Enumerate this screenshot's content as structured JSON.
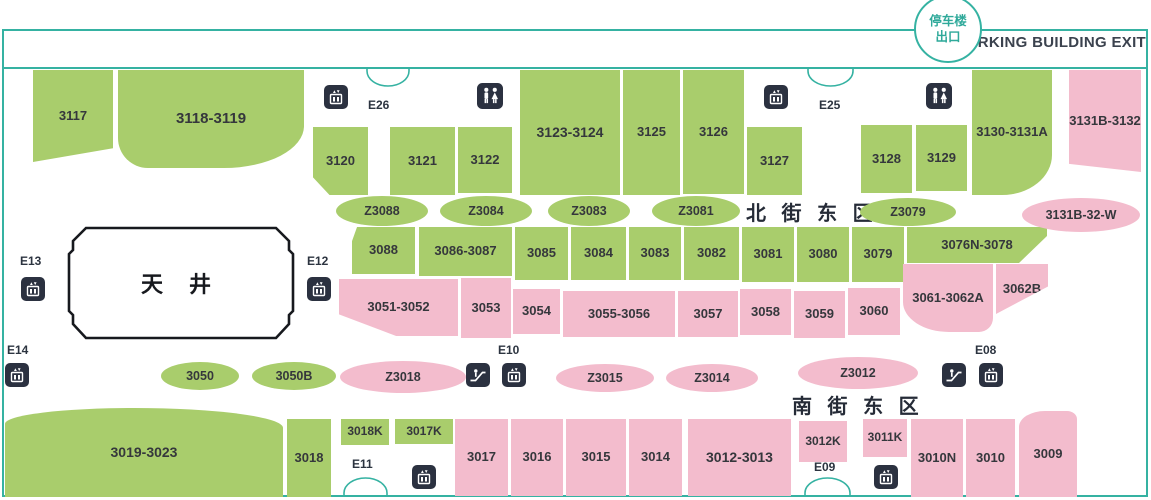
{
  "header": {
    "circle_line1": "停车楼",
    "circle_line2": "出口",
    "exit_text": "PARKING BUILDING EXIT"
  },
  "districts": {
    "north": "北 街 东 区",
    "south": "南 街 东 区"
  },
  "atrium": {
    "label": "天 井"
  },
  "colors": {
    "teal": "#35b2a2",
    "green": "#a9cd6c",
    "pink": "#f3bccd",
    "icon_bg": "#2b3140",
    "text_dark": "#35373c"
  },
  "shops": [
    {
      "label": "3117",
      "x": 33,
      "y": 70,
      "w": 80,
      "h": 92,
      "color": "green",
      "clip": "polygon(0 0,100% 0,100% 85%,0 100%)"
    },
    {
      "label": "3118-3119",
      "x": 118,
      "y": 70,
      "w": 186,
      "h": 98,
      "color": "green",
      "r": "0 0 80px 30px / 0 0 42px 30px",
      "fs": 15
    },
    {
      "label": "3120",
      "x": 313,
      "y": 127,
      "w": 55,
      "h": 68,
      "color": "green",
      "clip": "polygon(0 0,100% 0,100% 100%,30% 100%,0 74%)"
    },
    {
      "label": "3121",
      "x": 390,
      "y": 127,
      "w": 65,
      "h": 68,
      "color": "green"
    },
    {
      "label": "3122",
      "x": 458,
      "y": 127,
      "w": 54,
      "h": 66,
      "color": "green"
    },
    {
      "label": "3123-3124",
      "x": 520,
      "y": 70,
      "w": 100,
      "h": 125,
      "color": "green",
      "fs": 14
    },
    {
      "label": "3125",
      "x": 623,
      "y": 70,
      "w": 57,
      "h": 125,
      "color": "green"
    },
    {
      "label": "3126",
      "x": 683,
      "y": 70,
      "w": 61,
      "h": 124,
      "color": "green"
    },
    {
      "label": "3127",
      "x": 747,
      "y": 127,
      "w": 55,
      "h": 68,
      "color": "green"
    },
    {
      "label": "3128",
      "x": 861,
      "y": 125,
      "w": 51,
      "h": 68,
      "color": "green"
    },
    {
      "label": "3129",
      "x": 916,
      "y": 125,
      "w": 51,
      "h": 66,
      "color": "green"
    },
    {
      "label": "3130-3131A",
      "x": 972,
      "y": 70,
      "w": 80,
      "h": 125,
      "color": "green",
      "r": "0 0 50px 0 / 0 0 40px 0"
    },
    {
      "label": "3131B-3132",
      "x": 1069,
      "y": 70,
      "w": 72,
      "h": 102,
      "color": "pink",
      "clip": "polygon(0 0,100% 0,100% 100%,0 92%)"
    },
    {
      "label": "3088",
      "x": 352,
      "y": 227,
      "w": 63,
      "h": 47,
      "color": "green",
      "clip": "polygon(8% 0,100% 0,100% 100%,0 100%,0 30%)"
    },
    {
      "label": "3086-3087",
      "x": 419,
      "y": 227,
      "w": 93,
      "h": 49,
      "color": "green"
    },
    {
      "label": "3085",
      "x": 515,
      "y": 227,
      "w": 53,
      "h": 53,
      "color": "green"
    },
    {
      "label": "3084",
      "x": 571,
      "y": 227,
      "w": 55,
      "h": 53,
      "color": "green"
    },
    {
      "label": "3083",
      "x": 629,
      "y": 227,
      "w": 52,
      "h": 53,
      "color": "green"
    },
    {
      "label": "3082",
      "x": 684,
      "y": 227,
      "w": 55,
      "h": 53,
      "color": "green"
    },
    {
      "label": "3081",
      "x": 742,
      "y": 227,
      "w": 52,
      "h": 55,
      "color": "green"
    },
    {
      "label": "3080",
      "x": 797,
      "y": 227,
      "w": 52,
      "h": 55,
      "color": "green"
    },
    {
      "label": "3079",
      "x": 852,
      "y": 227,
      "w": 52,
      "h": 55,
      "color": "green"
    },
    {
      "label": "3076N-3078",
      "x": 907,
      "y": 227,
      "w": 140,
      "h": 36,
      "color": "green",
      "clip": "polygon(0 0,100% 0,100% 25%,80% 100%,0 100%)"
    },
    {
      "label": "3051-3052",
      "x": 339,
      "y": 279,
      "w": 119,
      "h": 57,
      "color": "pink",
      "clip": "polygon(0 0,100% 0,100% 100%,48% 100%,0 62%)"
    },
    {
      "label": "3053",
      "x": 461,
      "y": 278,
      "w": 50,
      "h": 60,
      "color": "pink"
    },
    {
      "label": "3054",
      "x": 513,
      "y": 289,
      "w": 47,
      "h": 45,
      "color": "pink"
    },
    {
      "label": "3055-3056",
      "x": 563,
      "y": 291,
      "w": 112,
      "h": 46,
      "color": "pink"
    },
    {
      "label": "3057",
      "x": 678,
      "y": 291,
      "w": 60,
      "h": 46,
      "color": "pink"
    },
    {
      "label": "3058",
      "x": 740,
      "y": 289,
      "w": 51,
      "h": 46,
      "color": "pink"
    },
    {
      "label": "3059",
      "x": 794,
      "y": 291,
      "w": 51,
      "h": 47,
      "color": "pink"
    },
    {
      "label": "3060",
      "x": 848,
      "y": 288,
      "w": 52,
      "h": 47,
      "color": "pink"
    },
    {
      "label": "3061-3062A",
      "x": 903,
      "y": 264,
      "w": 90,
      "h": 68,
      "color": "pink",
      "r": "0 0 14px 46px / 0 0 14px 30px"
    },
    {
      "label": "3062B",
      "x": 996,
      "y": 264,
      "w": 52,
      "h": 50,
      "color": "pink",
      "clip": "polygon(0 0,100% 0,100% 45%,0 100%)"
    },
    {
      "label": "3019-3023",
      "x": 5,
      "y": 408,
      "w": 278,
      "h": 89,
      "color": "green",
      "r": "130px 150px 0 0 / 16px 20px 0 0",
      "fs": 14
    },
    {
      "label": "3018",
      "x": 287,
      "y": 419,
      "w": 44,
      "h": 78,
      "color": "green"
    },
    {
      "label": "3018K",
      "x": 341,
      "y": 419,
      "w": 48,
      "h": 26,
      "color": "green",
      "fs": 12
    },
    {
      "label": "3017K",
      "x": 395,
      "y": 419,
      "w": 58,
      "h": 25,
      "color": "green",
      "fs": 12
    },
    {
      "label": "3017",
      "x": 455,
      "y": 419,
      "w": 53,
      "h": 77,
      "color": "pink"
    },
    {
      "label": "3016",
      "x": 511,
      "y": 419,
      "w": 52,
      "h": 77,
      "color": "pink"
    },
    {
      "label": "3015",
      "x": 566,
      "y": 419,
      "w": 60,
      "h": 77,
      "color": "pink"
    },
    {
      "label": "3014",
      "x": 629,
      "y": 419,
      "w": 53,
      "h": 77,
      "color": "pink"
    },
    {
      "label": "3012-3013",
      "x": 688,
      "y": 419,
      "w": 103,
      "h": 77,
      "color": "pink",
      "fs": 14
    },
    {
      "label": "3012K",
      "x": 799,
      "y": 421,
      "w": 48,
      "h": 41,
      "color": "pink",
      "fs": 12
    },
    {
      "label": "3011K",
      "x": 863,
      "y": 419,
      "w": 44,
      "h": 38,
      "color": "pink",
      "fs": 12
    },
    {
      "label": "3010N",
      "x": 911,
      "y": 419,
      "w": 52,
      "h": 78,
      "color": "pink"
    },
    {
      "label": "3010",
      "x": 966,
      "y": 419,
      "w": 49,
      "h": 78,
      "color": "pink"
    },
    {
      "label": "3009",
      "x": 1019,
      "y": 411,
      "w": 58,
      "h": 86,
      "color": "pink",
      "r": "26px 10px 0 0 / 16px 8px 0 0"
    }
  ],
  "ovals": [
    {
      "label": "Z3088",
      "cx": 382,
      "cy": 211,
      "rx": 46,
      "ry": 15,
      "color": "green"
    },
    {
      "label": "Z3084",
      "cx": 486,
      "cy": 211,
      "rx": 46,
      "ry": 15,
      "color": "green"
    },
    {
      "label": "Z3083",
      "cx": 589,
      "cy": 211,
      "rx": 41,
      "ry": 15,
      "color": "green"
    },
    {
      "label": "Z3081",
      "cx": 696,
      "cy": 211,
      "rx": 44,
      "ry": 15,
      "color": "green"
    },
    {
      "label": "Z3079",
      "cx": 908,
      "cy": 212,
      "rx": 48,
      "ry": 14,
      "color": "green"
    },
    {
      "label": "3131B-32-W",
      "cx": 1081,
      "cy": 215,
      "rx": 59,
      "ry": 17,
      "color": "pink"
    },
    {
      "label": "3050",
      "cx": 200,
      "cy": 376,
      "rx": 39,
      "ry": 14,
      "color": "green"
    },
    {
      "label": "3050B",
      "cx": 294,
      "cy": 376,
      "rx": 42,
      "ry": 14,
      "color": "green"
    },
    {
      "label": "Z3018",
      "cx": 403,
      "cy": 377,
      "rx": 63,
      "ry": 16,
      "color": "pink"
    },
    {
      "label": "Z3015",
      "cx": 605,
      "cy": 378,
      "rx": 49,
      "ry": 14,
      "color": "pink"
    },
    {
      "label": "Z3014",
      "cx": 712,
      "cy": 378,
      "rx": 46,
      "ry": 14,
      "color": "pink"
    },
    {
      "label": "Z3012",
      "cx": 858,
      "cy": 373,
      "rx": 60,
      "ry": 16,
      "color": "pink"
    }
  ],
  "exits": [
    {
      "label": "E26",
      "x": 368,
      "y": 98
    },
    {
      "label": "E25",
      "x": 819,
      "y": 98
    },
    {
      "label": "E13",
      "x": 20,
      "y": 254
    },
    {
      "label": "E12",
      "x": 307,
      "y": 254
    },
    {
      "label": "E14",
      "x": 7,
      "y": 343
    },
    {
      "label": "E10",
      "x": 498,
      "y": 343
    },
    {
      "label": "E08",
      "x": 975,
      "y": 343
    },
    {
      "label": "E11",
      "x": 352,
      "y": 457
    },
    {
      "label": "E09",
      "x": 814,
      "y": 460
    }
  ],
  "icons": [
    {
      "type": "elevator",
      "x": 324,
      "y": 85,
      "s": 24
    },
    {
      "type": "restroom",
      "x": 477,
      "y": 83,
      "s": 26
    },
    {
      "type": "elevator",
      "x": 764,
      "y": 85,
      "s": 24
    },
    {
      "type": "restroom",
      "x": 926,
      "y": 83,
      "s": 26
    },
    {
      "type": "elevator",
      "x": 21,
      "y": 277,
      "s": 24
    },
    {
      "type": "elevator",
      "x": 307,
      "y": 277,
      "s": 24
    },
    {
      "type": "elevator",
      "x": 5,
      "y": 363,
      "s": 24
    },
    {
      "type": "escalator",
      "x": 466,
      "y": 363,
      "s": 24
    },
    {
      "type": "elevator",
      "x": 502,
      "y": 363,
      "s": 24
    },
    {
      "type": "escalator",
      "x": 942,
      "y": 363,
      "s": 24
    },
    {
      "type": "elevator",
      "x": 979,
      "y": 363,
      "s": 24
    },
    {
      "type": "elevator",
      "x": 412,
      "y": 465,
      "s": 24
    },
    {
      "type": "elevator",
      "x": 874,
      "y": 465,
      "s": 24
    }
  ],
  "doors": [
    {
      "id": "e26",
      "x": 366,
      "y": 67,
      "w": 44,
      "dir": "down"
    },
    {
      "id": "e25",
      "x": 807,
      "y": 67,
      "w": 47,
      "dir": "down"
    },
    {
      "id": "e11",
      "x": 343,
      "y": 476,
      "w": 45,
      "dir": "up"
    },
    {
      "id": "e09",
      "x": 804,
      "y": 476,
      "w": 47,
      "dir": "up"
    }
  ]
}
